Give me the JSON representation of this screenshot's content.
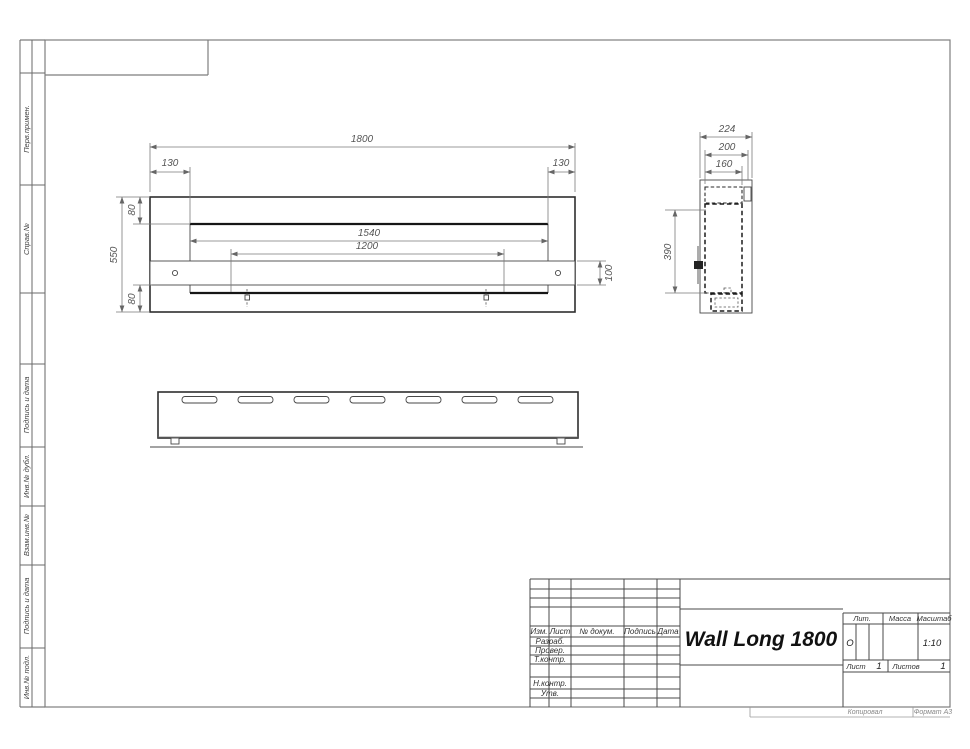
{
  "sidebar": {
    "labels": [
      "Перв.примен.",
      "Справ.№",
      "Подпись и дата",
      "Инв.№ дубл.",
      "Взам.инв.№",
      "Подпись и дата",
      "Инв.№ подл."
    ]
  },
  "title_block": {
    "name": "Wall Long 1800",
    "columns": {
      "izm": "Изм.",
      "sheet": "Лист",
      "doc": "№ докум.",
      "sign": "Подпись",
      "date": "Дата"
    },
    "rows": {
      "developed": "Разраб.",
      "checked": "Провер.",
      "tcontrol": "Т.контр.",
      "ncontrol": "Н.контр.",
      "approved": "Утв."
    },
    "lit": {
      "label": "Лит.",
      "value": "О"
    },
    "mass": {
      "label": "Масса"
    },
    "scale": {
      "label": "Масштаб",
      "value": "1:10"
    },
    "sheet_no": {
      "label": "Лист",
      "value": "1"
    },
    "sheets_total": {
      "label": "Листов",
      "value": "1"
    }
  },
  "footer": {
    "copied": "Копировал",
    "format": "Формат А3"
  },
  "dims": {
    "front": {
      "overall_width": "1800",
      "left_offset": "130",
      "right_offset": "130",
      "top_inset": "80",
      "opening_width": "1540",
      "mount_span": "1200",
      "overall_height": "550",
      "bottom_inset": "80",
      "shelf_height": "100"
    },
    "side": {
      "overall_depth": "224",
      "body_depth": "200",
      "inner_depth": "160",
      "mount_height": "390"
    }
  }
}
